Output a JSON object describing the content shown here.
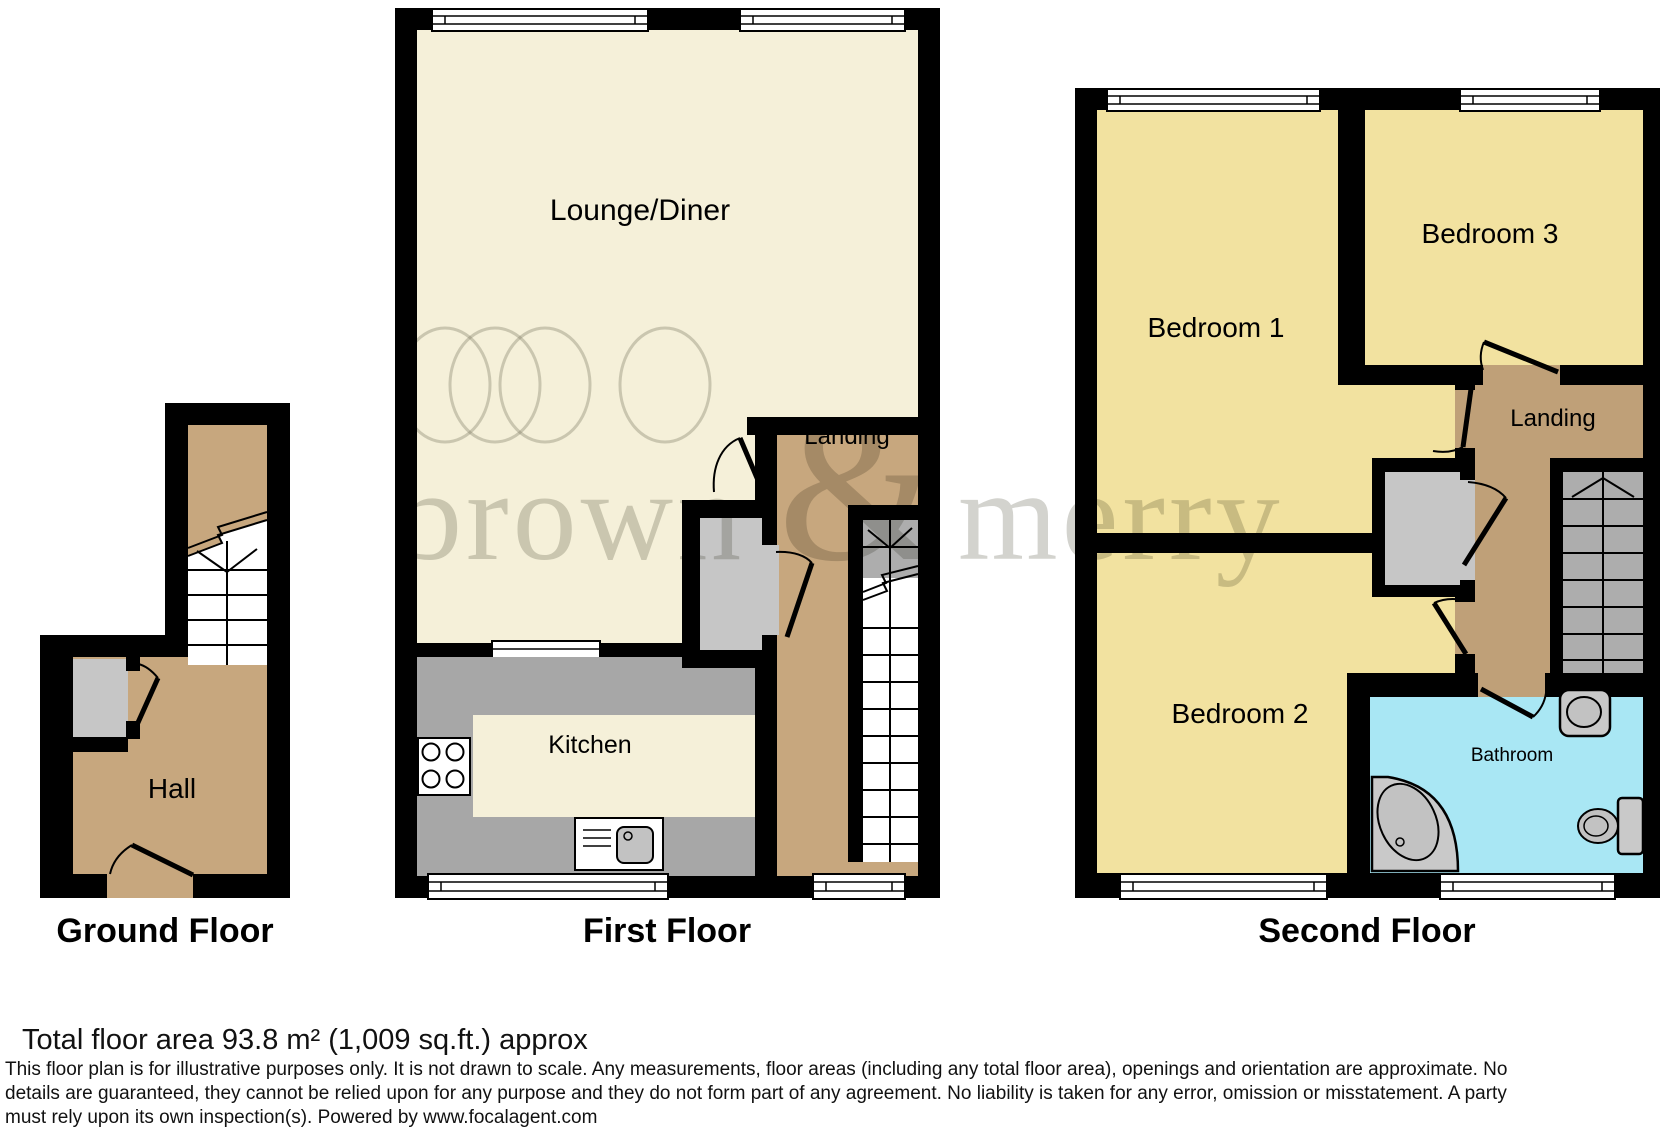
{
  "watermark": {
    "word_left": "brown",
    "amp": "&",
    "word_right": "merry"
  },
  "floors": {
    "ground": {
      "caption": "Ground Floor",
      "rooms": {
        "hall": "Hall"
      }
    },
    "first": {
      "caption": "First Floor",
      "rooms": {
        "lounge": "Lounge/Diner",
        "landing": "Landing",
        "kitchen": "Kitchen"
      }
    },
    "second": {
      "caption": "Second Floor",
      "rooms": {
        "bedroom1": "Bedroom 1",
        "bedroom2": "Bedroom 2",
        "bedroom3": "Bedroom 3",
        "landing": "Landing",
        "bathroom": "Bathroom"
      }
    }
  },
  "footer": {
    "total_area": "Total floor area 93.8 m² (1,009 sq.ft.) approx",
    "disclaimer_lines": [
      "This floor plan is for illustrative purposes only. It is not drawn to scale. Any measurements, floor areas (including any total floor area), openings and orientation are approximate. No",
      "details are guaranteed, they cannot be relied upon for any purpose and they do not form part of any agreement. No liability is taken for any error, omission or misstatement. A party",
      "must rely upon its own inspection(s). Powered by www.focalagent.com"
    ]
  },
  "colors": {
    "wall": "#000000",
    "hall_landing_tan": "#C7A77E",
    "second_landing_tan": "#BFA078",
    "lounge_cream": "#F5F0D9",
    "bedroom_yellow": "#F2E2A0",
    "bathroom_blue": "#A9E7F4",
    "kitchen_gray": "#A7A7A7",
    "cupboard_gray": "#C6C6C6",
    "stairs_gray": "#ADADAD",
    "fixture_gray": "#C9C9C9",
    "watermark_gray": "#7D7D6E"
  }
}
